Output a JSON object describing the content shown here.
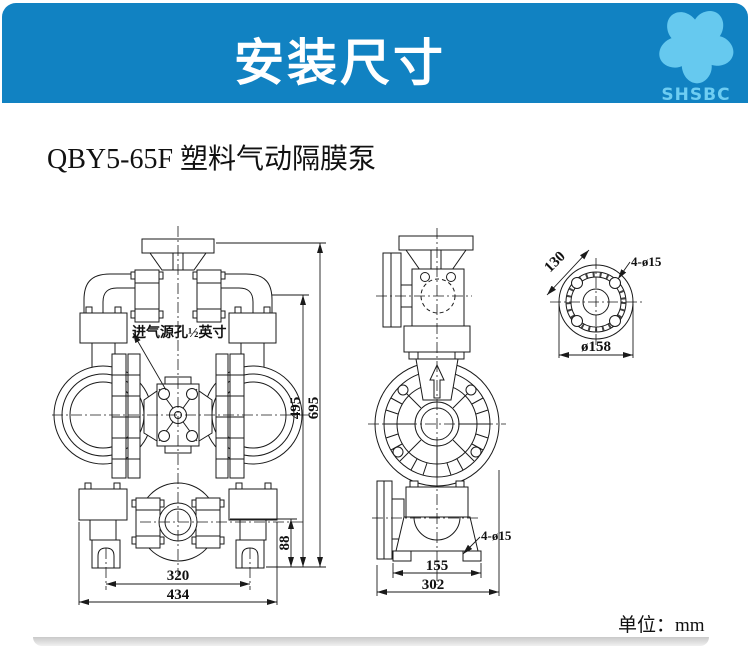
{
  "header": {
    "title": "安装尺寸",
    "logo_text": "SHSBC"
  },
  "page": {
    "product_title": "QBY5-65F 塑料气动隔膜泵",
    "unit_label": "单位：mm"
  },
  "dims": {
    "front": {
      "inlet_note": "进气源孔½英寸",
      "h495": "495",
      "h695": "695",
      "h88": "88",
      "w320": "320",
      "w434": "434"
    },
    "side": {
      "w155": "155",
      "w302": "302",
      "holes": "4-ø15"
    },
    "flange": {
      "bolt_circle": "130",
      "outer_dia": "ø158",
      "holes": "4-ø15"
    }
  },
  "colors": {
    "banner_blue": "#1182c2",
    "logo_blue": "#6ecdf2",
    "line": "#1a1a1a"
  }
}
